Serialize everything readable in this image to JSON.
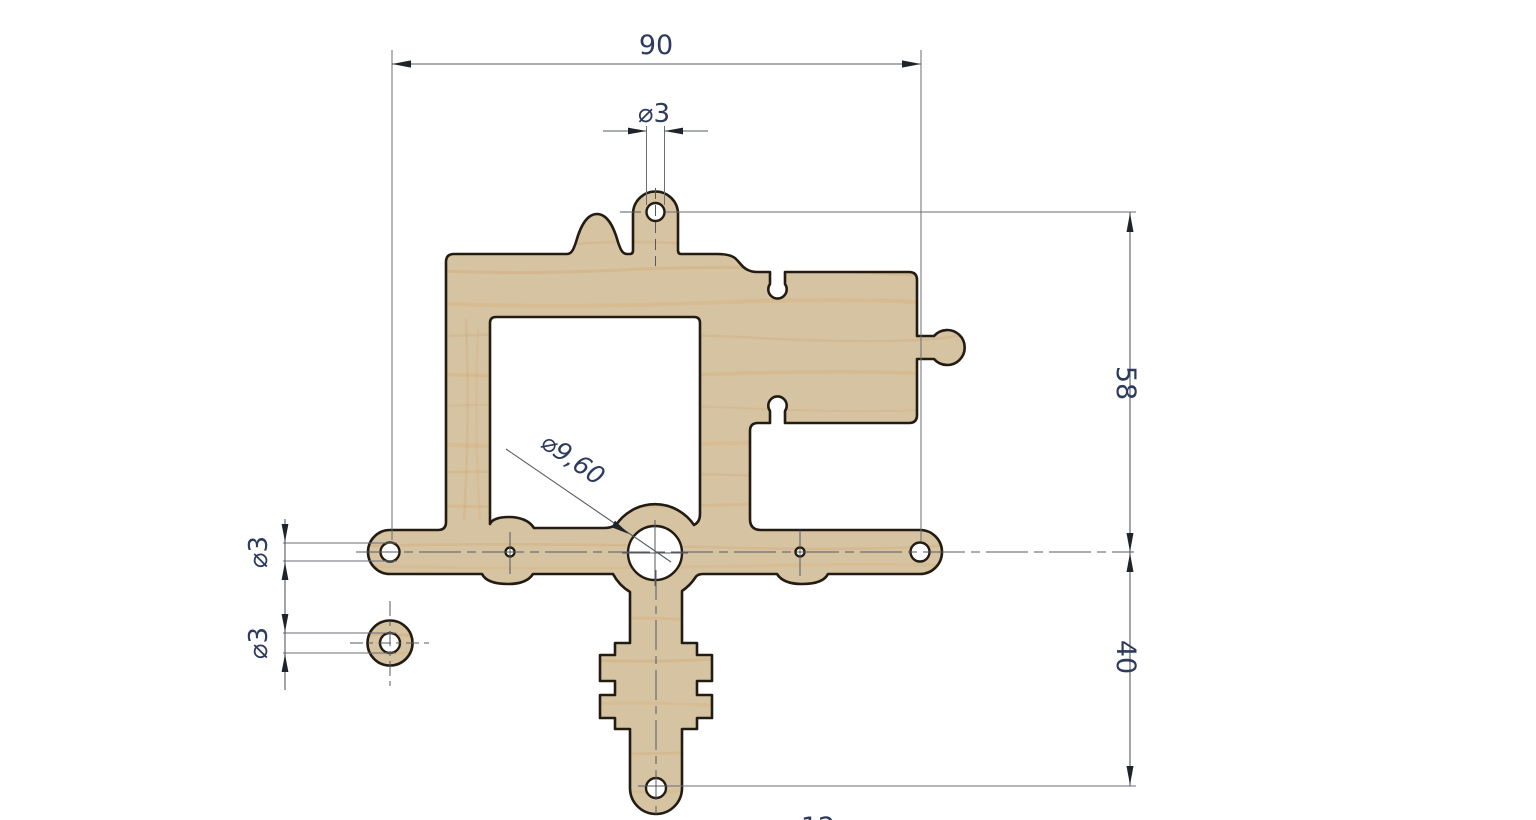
{
  "drawing": {
    "type": "CAD dimensioned drawing of a laser-cut wooden bracket part",
    "background": "#ffffff",
    "colors": {
      "wood_fill": "#d6c3a2",
      "wood_grain": "#cf9d5e",
      "part_outline": "#221c13",
      "dimension_line": "#565b63",
      "dimension_text": "#2e3b5e"
    },
    "dims": {
      "overall_width": "90",
      "top_hole_dia": "⌀3",
      "upper_height": "58",
      "lower_height": "40",
      "center_hole_dia": "⌀9,60",
      "arm_hole_dia": "⌀3",
      "disc_hole_dia": "⌀3",
      "bottom_partial": "12"
    }
  }
}
